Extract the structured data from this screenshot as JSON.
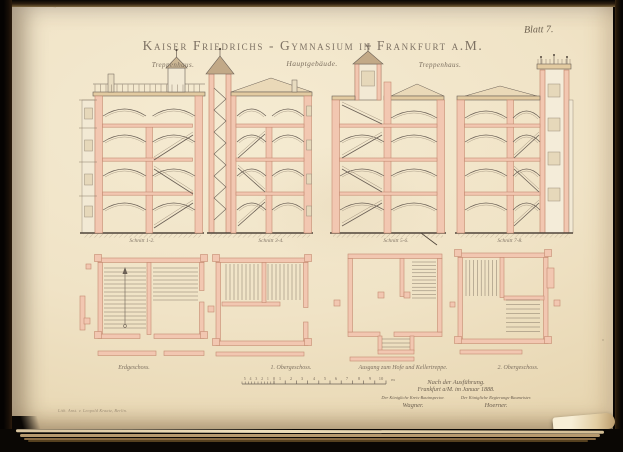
{
  "plate": {
    "blatt_label": "Blatt 7.",
    "title": "Kaiser Friedrichs - Gymnasium in Frankfurt a.M."
  },
  "group_labels": {
    "left": "Treppenhaus.",
    "center": "Hauptgebäude.",
    "right": "Treppenhaus."
  },
  "section_labels": {
    "s1": "Schnitt 1-2.",
    "s2": "Schnitt 3-4.",
    "s3": "Schnitt 5-6.",
    "s4": "Schnitt 7-8."
  },
  "plan_labels": {
    "p1": "Erdgeschoss.",
    "p2": "1. Obergeschoss.",
    "p3": "Ausgang zum Hofe und Kellertreppe.",
    "p4": "2. Obergeschoss."
  },
  "scale_bar": {
    "left_numbers": "5 4 3 2 1",
    "zero": "0",
    "numbers": {
      "n1": "1",
      "n2": "2",
      "n3": "3",
      "n4": "4",
      "n5": "5",
      "n6": "6",
      "n7": "7",
      "n8": "8",
      "n9": "9",
      "n10": "10"
    },
    "unit": "m"
  },
  "colophon": {
    "line1": "Nach der Ausführung.",
    "line2": "Frankfurt a/M. im Januar 1888.",
    "left_title": "Der Königliche Kreis-Bauinspector.",
    "left_signature": "Wagner.",
    "right_title": "Der Königliche Regierungs-Baumeister.",
    "right_signature": "Hoerner.",
    "imprint": "Lith. Anst. v. Leopold Kraatz, Berlin."
  }
}
